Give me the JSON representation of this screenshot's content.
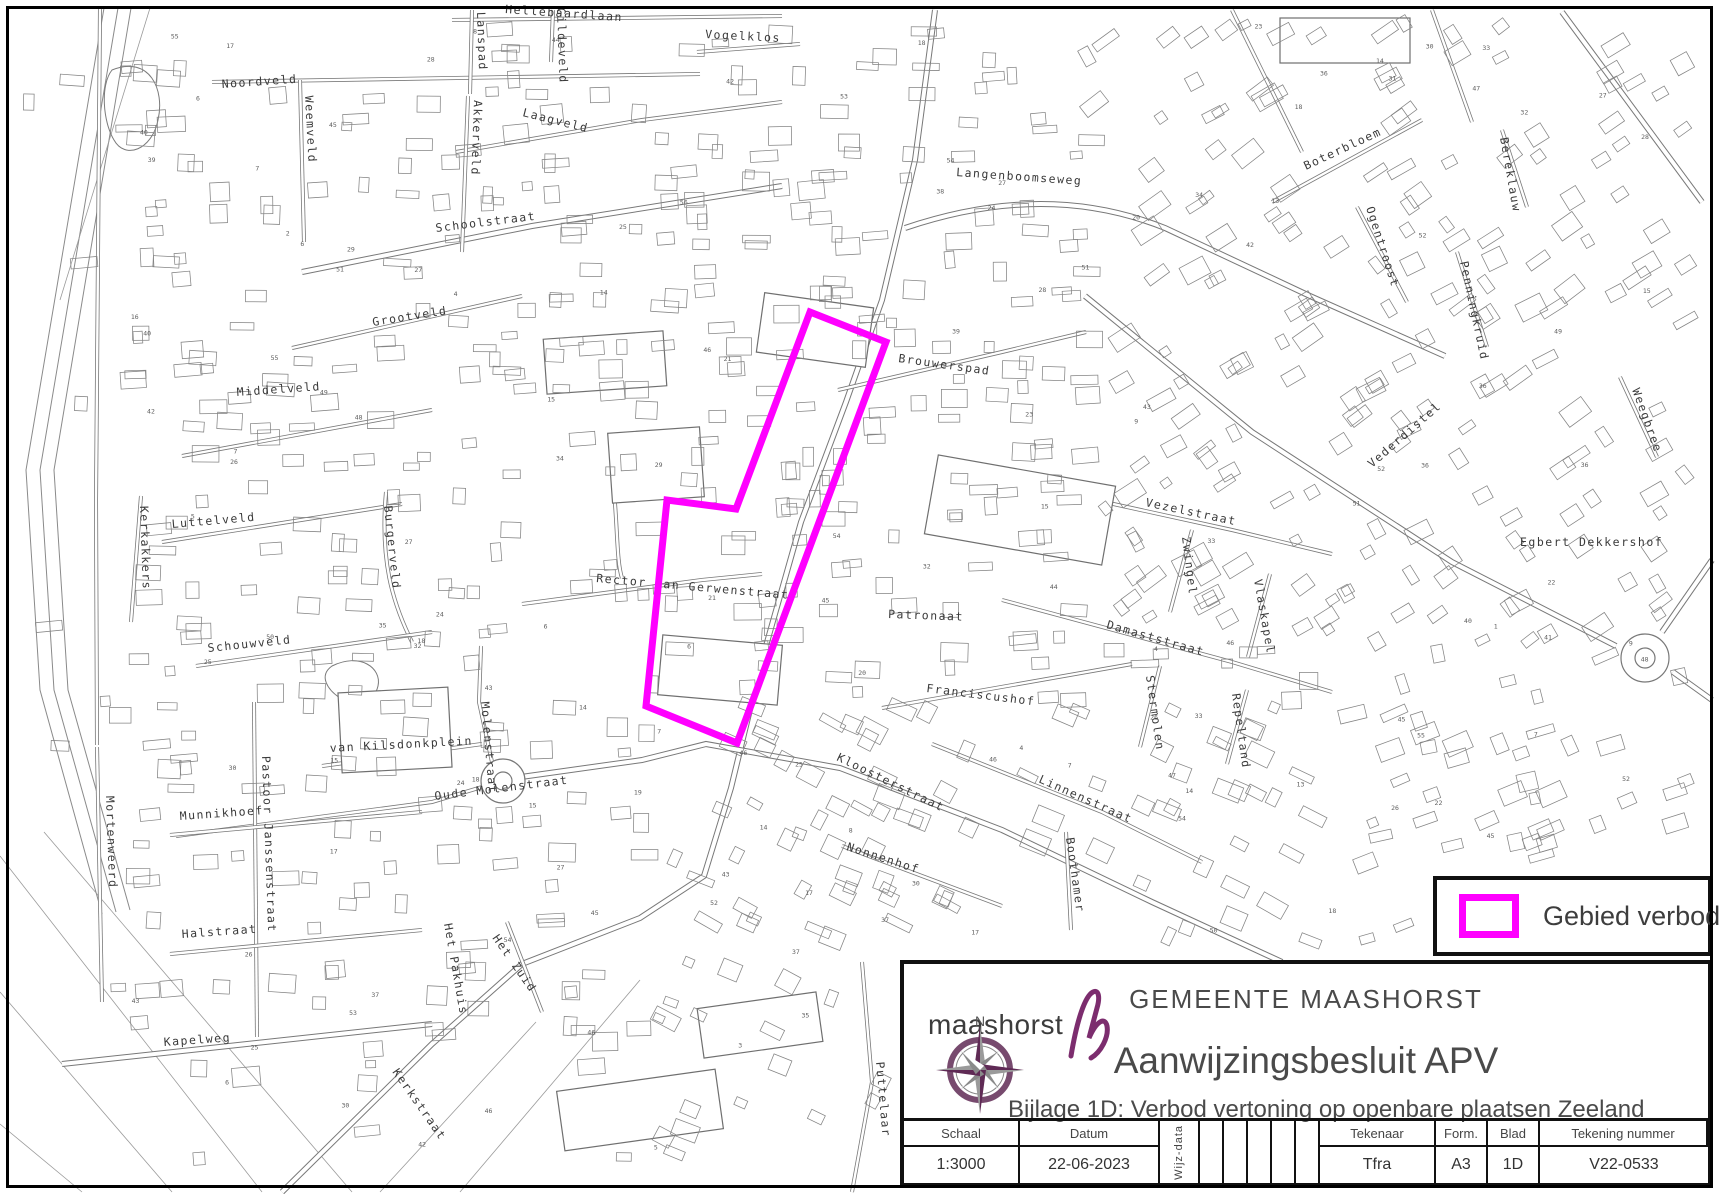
{
  "legend": {
    "label": "Gebied verbod",
    "swatch_color": "#ff00ff"
  },
  "title_block": {
    "logo_text": "maashorst",
    "municipality": "GEMEENTE MAASHORST",
    "document_title": "Aanwijzingsbesluit APV",
    "document_subtitle": "Bijlage 1D: Verbod vertoning op openbare plaatsen Zeeland",
    "compass_north_label": "N",
    "table": {
      "schaal_label": "Schaal",
      "schaal_value": "1:3000",
      "datum_label": "Datum",
      "datum_value": "22-06-2023",
      "wijz_label": "Wijz-data",
      "tekenaar_label": "Tekenaar",
      "tekenaar_value": "Tfra",
      "form_label": "Form.",
      "form_value": "A3",
      "blad_label": "Blad",
      "blad_value": "1D",
      "tekening_label": "Tekening nummer",
      "tekening_value": "V22-0533"
    }
  },
  "map": {
    "highlight_color": "#ff00ff",
    "ink_color": "#6f6f6f",
    "forbidden_area_points": [
      [
        810,
        312
      ],
      [
        886,
        342
      ],
      [
        737,
        743
      ],
      [
        646,
        706
      ],
      [
        667,
        500
      ],
      [
        736,
        509
      ]
    ],
    "street_labels": [
      {
        "t": "Hellebaardlaan",
        "x": 505,
        "y": 13,
        "r": 4
      },
      {
        "t": "Noordveld",
        "x": 222,
        "y": 88,
        "r": -4
      },
      {
        "t": "Weemveld",
        "x": 305,
        "y": 96,
        "r": 87
      },
      {
        "t": "Lanspad",
        "x": 477,
        "y": 12,
        "r": 88
      },
      {
        "t": "Gildeveld",
        "x": 557,
        "y": 8,
        "r": 88
      },
      {
        "t": "Vogelklos",
        "x": 705,
        "y": 38,
        "r": 3
      },
      {
        "t": "Laagveld",
        "x": 522,
        "y": 116,
        "r": 14
      },
      {
        "t": "Akkerveld",
        "x": 474,
        "y": 100,
        "r": 92
      },
      {
        "t": "Schoolstraat",
        "x": 436,
        "y": 232,
        "r": -7
      },
      {
        "t": "Langenboomseweg",
        "x": 956,
        "y": 176,
        "r": 4
      },
      {
        "t": "Grootveld",
        "x": 373,
        "y": 326,
        "r": -9
      },
      {
        "t": "Brouwerspad",
        "x": 898,
        "y": 362,
        "r": 8
      },
      {
        "t": "Boterbloem",
        "x": 1306,
        "y": 170,
        "r": -25
      },
      {
        "t": "Ogentroost",
        "x": 1366,
        "y": 208,
        "r": 72
      },
      {
        "t": "Penningkruid",
        "x": 1460,
        "y": 262,
        "r": 78
      },
      {
        "t": "Bereklauw",
        "x": 1500,
        "y": 138,
        "r": 80
      },
      {
        "t": "Middelveld",
        "x": 237,
        "y": 396,
        "r": -4
      },
      {
        "t": "Luttelveld",
        "x": 172,
        "y": 528,
        "r": -5
      },
      {
        "t": "Kerkakkers",
        "x": 140,
        "y": 506,
        "r": 88
      },
      {
        "t": "Burgerveld",
        "x": 384,
        "y": 506,
        "r": 84
      },
      {
        "t": "Vezelstraat",
        "x": 1145,
        "y": 506,
        "r": 12
      },
      {
        "t": "Zwingel",
        "x": 1182,
        "y": 537,
        "r": 83
      },
      {
        "t": "Vlaskapel",
        "x": 1254,
        "y": 580,
        "r": 80
      },
      {
        "t": "Vederdistel",
        "x": 1372,
        "y": 468,
        "r": -41
      },
      {
        "t": "Weegbree",
        "x": 1632,
        "y": 390,
        "r": 70
      },
      {
        "t": "Egbert Dekkershof",
        "x": 1520,
        "y": 546,
        "r": 0
      },
      {
        "t": "Schouwveld",
        "x": 208,
        "y": 652,
        "r": -6
      },
      {
        "t": "Damaststraat",
        "x": 1106,
        "y": 628,
        "r": 16
      },
      {
        "t": "Stermolen",
        "x": 1146,
        "y": 676,
        "r": 82
      },
      {
        "t": "Repeltand",
        "x": 1232,
        "y": 694,
        "r": 82
      },
      {
        "t": "Patronaat",
        "x": 888,
        "y": 618,
        "r": 2
      },
      {
        "t": "Franciscushof",
        "x": 926,
        "y": 692,
        "r": 7
      },
      {
        "t": "Rector van Gerwenstraat",
        "x": 596,
        "y": 582,
        "r": 5
      },
      {
        "t": "van Kilsdonkplein",
        "x": 330,
        "y": 752,
        "r": -3
      },
      {
        "t": "Molenstraat",
        "x": 481,
        "y": 702,
        "r": 85
      },
      {
        "t": "Oude Molenstraat",
        "x": 435,
        "y": 800,
        "r": -7
      },
      {
        "t": "Kloosterstraat",
        "x": 836,
        "y": 760,
        "r": 26
      },
      {
        "t": "Linnenstraat",
        "x": 1038,
        "y": 782,
        "r": 24
      },
      {
        "t": "Nonnenhof",
        "x": 846,
        "y": 850,
        "r": 18
      },
      {
        "t": "Boothamer",
        "x": 1066,
        "y": 838,
        "r": 82
      },
      {
        "t": "Munnikhoef",
        "x": 180,
        "y": 820,
        "r": -4
      },
      {
        "t": "Mortenweerd",
        "x": 106,
        "y": 796,
        "r": 88
      },
      {
        "t": "Pastoor Janssenstraat",
        "x": 262,
        "y": 756,
        "r": 88
      },
      {
        "t": "Halstraat",
        "x": 182,
        "y": 938,
        "r": -4
      },
      {
        "t": "Het Pakhuis",
        "x": 444,
        "y": 924,
        "r": 80
      },
      {
        "t": "Het Zuid",
        "x": 492,
        "y": 938,
        "r": 55
      },
      {
        "t": "Kapelweg",
        "x": 164,
        "y": 1046,
        "r": -4
      },
      {
        "t": "Kerkstraat",
        "x": 392,
        "y": 1072,
        "r": 55
      },
      {
        "t": "Puttelaar",
        "x": 876,
        "y": 1062,
        "r": 85
      }
    ]
  }
}
